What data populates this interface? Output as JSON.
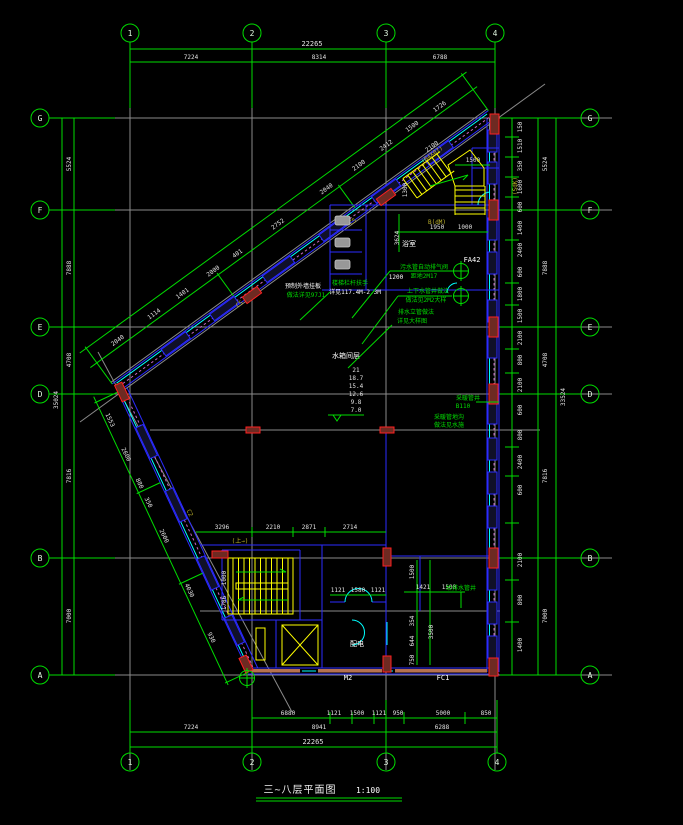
{
  "drawing_title": {
    "text": "三~八层平面图",
    "scale": "1:100"
  },
  "grid": {
    "cols": [
      "1",
      "2",
      "3",
      "4"
    ],
    "rows": [
      "G",
      "F",
      "E",
      "D",
      "B",
      "A"
    ]
  },
  "colors": {
    "line_green": "#00dc00",
    "wall_blue": "#2b2bff",
    "glazing_cyan": "#00ffff",
    "stair_yellow": "#ffff00",
    "column_red": "#ff2020",
    "construction_gray": "#8a8a8a",
    "hatch_magenta": "#c565c5",
    "sill_tan": "#b5704f"
  },
  "dims": {
    "top": {
      "total": "22265",
      "seg": [
        "7224",
        "8314",
        "6788"
      ]
    },
    "bottom": {
      "fine": [
        "6880",
        "1121",
        "1500",
        "1121",
        "950",
        "5000",
        "850"
      ],
      "seg": [
        "7224",
        "8941",
        "6288"
      ],
      "total": "22265"
    },
    "left": {
      "seg": [
        "5524",
        "7888",
        "4708",
        "7816",
        "7000"
      ],
      "total": "35024"
    },
    "right": {
      "fine": [
        "150",
        "1510",
        "350",
        "1600",
        "600",
        "1400",
        "2400",
        "600",
        "1800",
        "1500",
        "2100",
        "800",
        "2100",
        "600",
        "800",
        "2400",
        "600",
        "2100",
        "800",
        "1400"
      ],
      "seg": [
        "5524",
        "7888",
        "4708",
        "7816",
        "7000"
      ],
      "total": "33524"
    },
    "diag_upper": [
      "2040",
      "1114",
      "1401",
      "2000",
      "401",
      "2752",
      "2040",
      "2100",
      "2412",
      "1500",
      "1726"
    ],
    "diag_lower": [
      "1553",
      "2600",
      "880",
      "350",
      "2600",
      "4030",
      "930"
    ],
    "stair_block": [
      "3296",
      "2210",
      "2871",
      "2714"
    ],
    "bottom_inner": [
      "1121",
      "1580",
      "1121",
      "1421",
      "1500",
      "1500",
      "354",
      "644",
      "750",
      "3500",
      "1000",
      "1786"
    ],
    "froom": [
      "1950",
      "1000",
      "3624",
      "1500",
      "1300",
      "2100"
    ]
  },
  "labels": {
    "window_tags": [
      "C5",
      "C5",
      "C2"
    ],
    "stair_tag": "(B4X07)",
    "shaft_tag": "(SdK)",
    "bath_tag": "B(dM)",
    "up_tag": "(上→)",
    "door_tags": [
      "FA42",
      "M2",
      "FC1"
    ],
    "room_bath": "浴室",
    "room_power": "配电",
    "white_small": "1200"
  },
  "levels": {
    "title": "水箱间层",
    "values": [
      "21",
      "18.7",
      "15.4",
      "12.6",
      "9.8",
      "7.0"
    ]
  },
  "annotations": [
    {
      "l1": "污水管自动排气阀",
      "l2": "距地2M17"
    },
    {
      "l1": "上下水管井做法",
      "l2": "做法见2M2大样"
    },
    {
      "l1": "排水立管做法",
      "l2": "详见大样图"
    },
    {
      "l1": "预制外墙挂板",
      "l2": "做法详见97J1"
    },
    {
      "l1": "楼梯栏杆扶手",
      "l2": "详见117.4M-2.3M"
    },
    {
      "l1": "采暖管井",
      "l2": "B110"
    },
    {
      "l1": "给排水管井",
      "l2": ""
    },
    {
      "l1": "采暖管地沟",
      "l2": "做法见水施"
    }
  ]
}
